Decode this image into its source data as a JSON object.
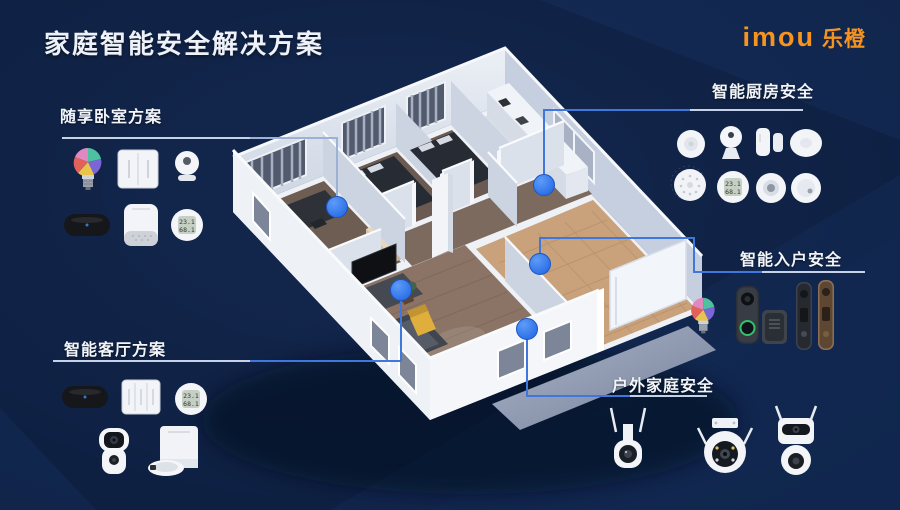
{
  "page": {
    "title": "家庭智能安全解决方案"
  },
  "brand": {
    "logo_en": "imou",
    "logo_cn": "乐橙",
    "logo_color": "#F7941E"
  },
  "groups": {
    "bedroom": {
      "label": "随享卧室方案",
      "products": [
        "rgb-smart-bulb",
        "smart-wall-switch-2gang",
        "indoor-pan-camera",
        "sleep-monitor-sensor",
        "smart-speaker-alarm",
        "temp-humidity-sensor"
      ]
    },
    "kitchen": {
      "label": "智能厨房安全",
      "products": [
        "smart-button",
        "kitchen-camera",
        "door-window-sensor",
        "ceiling-sensor",
        "smart-siren",
        "temp-humidity-sensor",
        "gas-detector",
        "smoke-detector"
      ]
    },
    "entry": {
      "label": "智能入户安全",
      "products": [
        "rgb-smart-bulb",
        "video-doorbell",
        "doorbell-chime",
        "smart-door-lock-black",
        "smart-door-lock-bronze"
      ]
    },
    "living": {
      "label": "智能客厅方案",
      "products": [
        "sleep-monitor-sensor",
        "smart-wall-switch-3gang",
        "temp-humidity-sensor",
        "dual-lens-indoor-camera",
        "robot-vacuum-with-dock"
      ]
    },
    "outdoor": {
      "label": "户外家庭安全",
      "products": [
        "outdoor-ptz-camera",
        "outdoor-dome-spotlight-camera",
        "outdoor-dual-lens-camera"
      ]
    }
  },
  "sensor_display": {
    "temperature": "23.1",
    "humidity": "68.1"
  },
  "markers": [
    "bedroom",
    "kitchen",
    "entry",
    "living-room",
    "outdoor"
  ],
  "colors": {
    "background": "#0E2042",
    "accent_dot": "#2C7BF0",
    "connector_line": "#3F77DC",
    "brand_orange": "#F7941E",
    "entry_floor": "#C9A27C"
  }
}
